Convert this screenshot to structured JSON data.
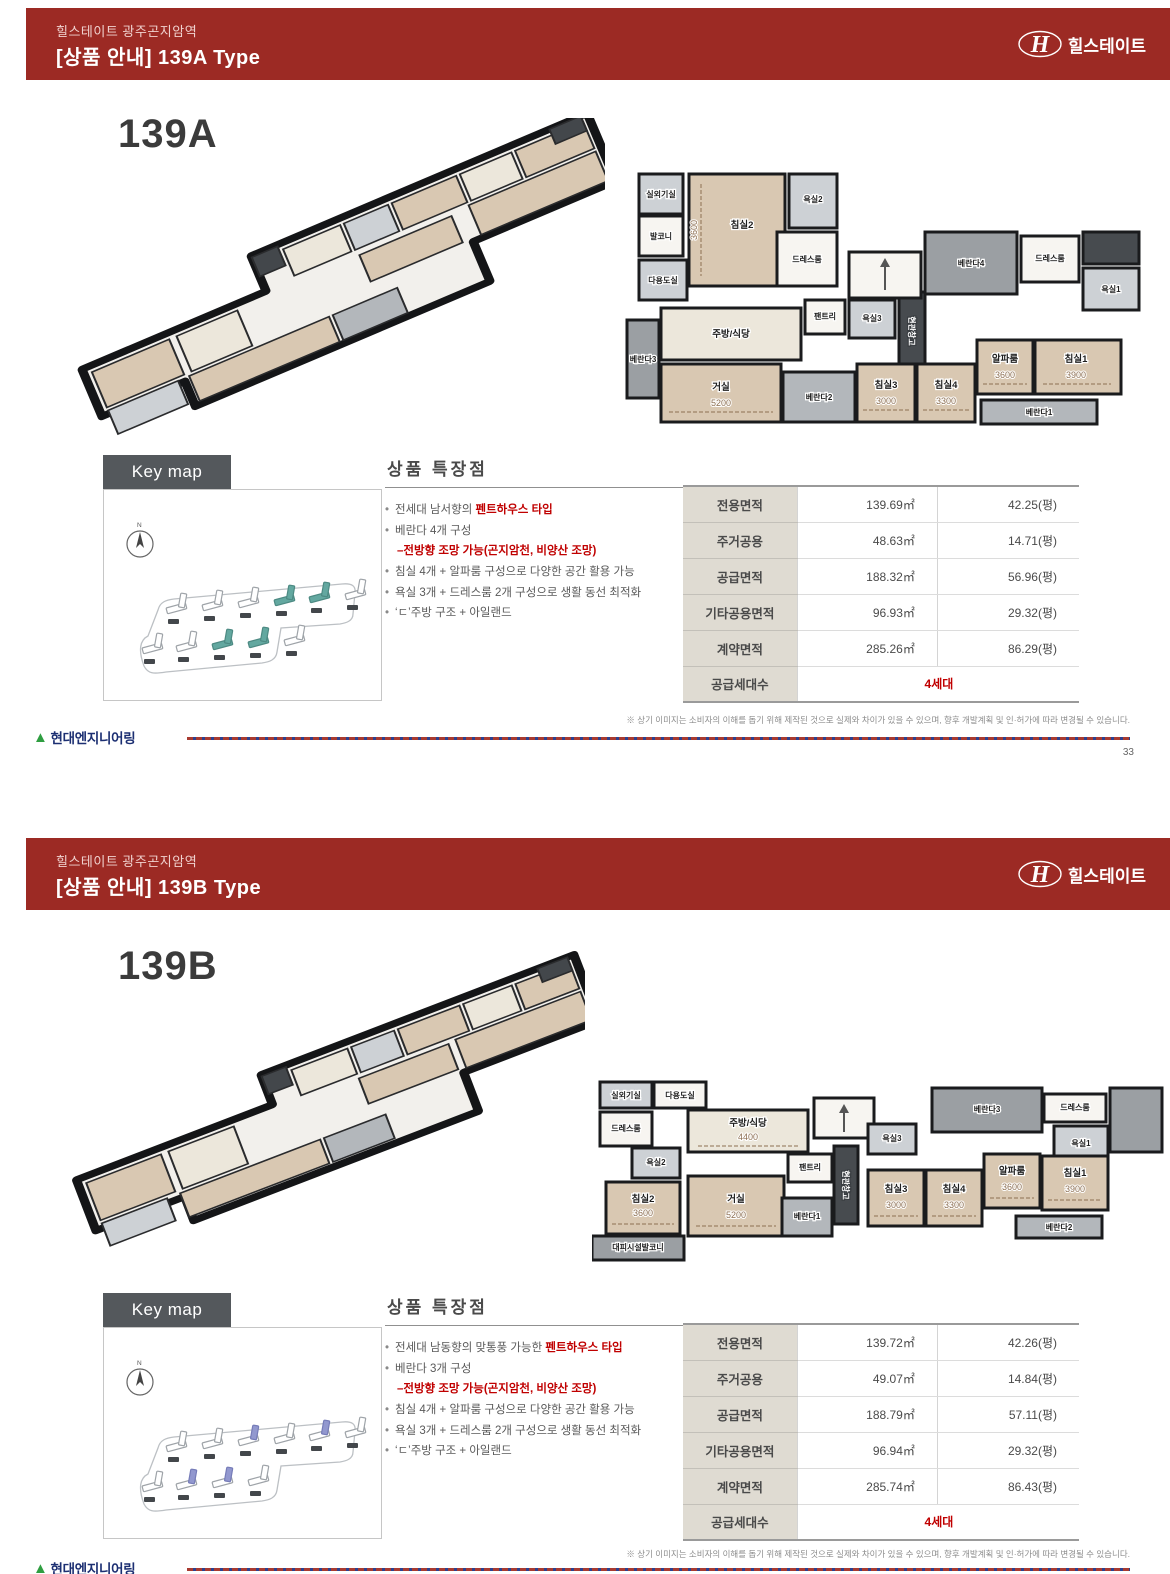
{
  "colors": {
    "header_red": "#9c2a24",
    "accent_red": "#c00000",
    "keymap_139a_highlight": "#63a8a0",
    "keymap_139b_highlight": "#9298cf"
  },
  "brand": {
    "logo_text": "힐스테이트",
    "footer_logo_text": "현대엔지니어링"
  },
  "page1": {
    "header": {
      "project": "힐스테이트 광주곤지암역",
      "title": "[상품 안내] 139A Type"
    },
    "type_label": "139A",
    "keymap": {
      "tab": "Key map",
      "north_label": "N"
    },
    "features": {
      "title": "상품 특장점",
      "line1_pre": "전세대 남서향의 ",
      "line1_red": "펜트하우스 타입",
      "line2": "베란다 4개 구성",
      "line3_red": "–전방향 조망 가능(곤지암천, 비양산 조망)",
      "line4": "침실 4개 + 알파룸 구성으로 다양한 공간 활용 가능",
      "line5": "욕실 3개 + 드레스룸 2개 구성으로 생활 동선 최적화",
      "line6": "‘ㄷ’주방 구조 + 아일랜드"
    },
    "table": {
      "rows": [
        {
          "label": "전용면적",
          "area": "139.69㎡",
          "pyeong": "42.25(평)"
        },
        {
          "label": "주거공용",
          "area": "48.63㎡",
          "pyeong": "14.71(평)"
        },
        {
          "label": "공급면적",
          "area": "188.32㎡",
          "pyeong": "56.96(평)"
        },
        {
          "label": "기타공용면적",
          "area": "96.93㎡",
          "pyeong": "29.32(평)"
        },
        {
          "label": "계약면적",
          "area": "285.26㎡",
          "pyeong": "86.29(평)"
        },
        {
          "label": "공급세대수",
          "value": "4세대"
        }
      ]
    },
    "plan": {
      "outdoor_unit": "실외기실",
      "balcony": "발코니",
      "utility": "다용도실",
      "bed2": "침실2",
      "bed2_dim": "3600",
      "bath2": "욕실2",
      "dress_left": "드레스룸",
      "kitchen": "주방/식당",
      "pantry": "팬트리",
      "bath3": "욕실3",
      "entry_storage": "현관창고",
      "veranda3": "베란다3",
      "living": "거실",
      "living_dim": "5200",
      "veranda2": "베란다2",
      "bed3": "침실3",
      "bed3_dim": "3000",
      "bed4": "침실4",
      "bed4_dim": "3300",
      "alpha": "알파룸",
      "alpha_dim": "3600",
      "bed1": "침실1",
      "bed1_dim": "3900",
      "veranda1": "베란다1",
      "veranda4": "베란다4",
      "dress_right": "드레스룸",
      "bath1": "욕실1"
    },
    "footer": {
      "disclaimer": "※ 상기 이미지는 소비자의 이해를 돕기 위해 제작된 것으로 실제와 차이가 있을 수 있으며, 향후 개발계획 및 인·허가에 따라 변경될 수 있습니다.",
      "page_no": "33"
    }
  },
  "page2": {
    "header": {
      "project": "힐스테이트 광주곤지암역",
      "title": "[상품 안내] 139B Type"
    },
    "type_label": "139B",
    "keymap": {
      "tab": "Key map",
      "north_label": "N"
    },
    "features": {
      "title": "상품 특장점",
      "line1_pre": "전세대 남동향의 맞통풍 가능한 ",
      "line1_red": "펜트하우스 타입",
      "line2": "베란다 3개 구성",
      "line3_red": "–전방향 조망 가능(곤지암천, 비양산 조망)",
      "line4": "침실 4개 + 알파룸 구성으로 다양한 공간 활용 가능",
      "line5": "욕실 3개 + 드레스룸 2개 구성으로 생활 동선 최적화",
      "line6": "‘ㄷ’주방 구조 + 아일랜드"
    },
    "table": {
      "rows": [
        {
          "label": "전용면적",
          "area": "139.72㎡",
          "pyeong": "42.26(평)"
        },
        {
          "label": "주거공용",
          "area": "49.07㎡",
          "pyeong": "14.84(평)"
        },
        {
          "label": "공급면적",
          "area": "188.79㎡",
          "pyeong": "57.11(평)"
        },
        {
          "label": "기타공용면적",
          "area": "96.94㎡",
          "pyeong": "29.32(평)"
        },
        {
          "label": "계약면적",
          "area": "285.74㎡",
          "pyeong": "86.43(평)"
        },
        {
          "label": "공급세대수",
          "value": "4세대"
        }
      ]
    },
    "plan": {
      "outdoor_unit": "실외기실",
      "utility": "다용도실",
      "kitchen": "주방/식당",
      "kitchen_dim": "4400",
      "dress_left": "드레스룸",
      "bath2": "욕실2",
      "pantry": "팬트리",
      "entry_storage": "현관창고",
      "bed2": "침실2",
      "bed2_dim": "3600",
      "living": "거실",
      "living_dim": "5200",
      "veranda1": "베란다1",
      "shelter": "대피시설발코니",
      "bath3": "욕실3",
      "veranda3": "베란다3",
      "dress_right": "드레스룸",
      "bath1": "욕실1",
      "bed3": "침실3",
      "bed3_dim": "3000",
      "bed4": "침실4",
      "bed4_dim": "3300",
      "alpha": "알파룸",
      "alpha_dim": "3600",
      "bed1": "침실1",
      "bed1_dim": "3900",
      "veranda2": "베란다2"
    },
    "footer": {
      "disclaimer": "※ 상기 이미지는 소비자의 이해를 돕기 위해 제작된 것으로 실제와 차이가 있을 수 있으며, 향후 개발계획 및 인·허가에 따라 변경될 수 있습니다."
    }
  }
}
